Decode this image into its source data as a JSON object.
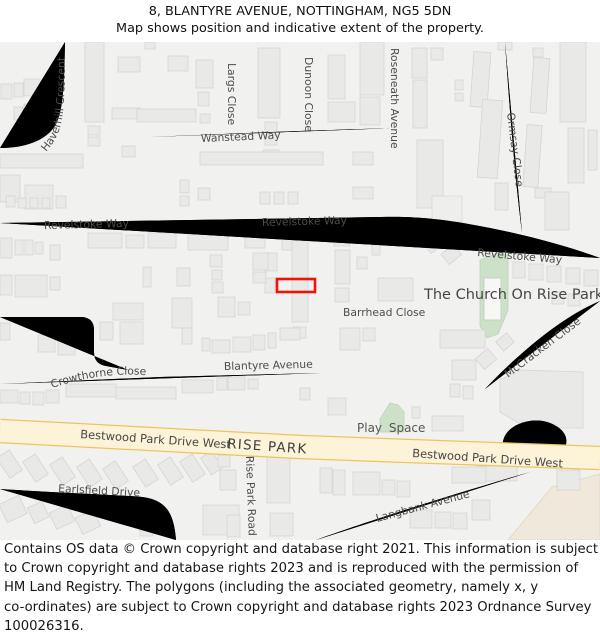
{
  "header": {
    "title": "8, BLANTYRE AVENUE, NOTTINGHAM, NG5 5DN",
    "subtitle": "Map shows position and indicative extent of the property."
  },
  "map": {
    "labels": {
      "haverhill": "Haverhill Crescent",
      "largs": "Largs Close",
      "dunoon": "Dunoon Close",
      "roseneath": "Roseneath Avenue",
      "ormsay": "Ormsay Close",
      "wanstead": "Wanstead Way",
      "revelstoke": "Revelstoke Way",
      "barrhead": "Barrhead Close",
      "church": "The Church On Rise Park",
      "mccracken": "McCracken Close",
      "blantyre": "Blantyre Avenue",
      "crowthorne": "Crowthorne Close",
      "bestwood": "Bestwood Park Drive West",
      "risepark": "RISE PARK",
      "earlsfield": "Earlsfield Drive",
      "riseparkroad": "Rise Park Road",
      "langbank": "Langbank Avenue",
      "playspace": "Play Space"
    },
    "colors": {
      "map_background": "#f1f1ef",
      "building_fill": "#e9e9e8",
      "road_fill": "#ffffff",
      "road_casing": "#d8d8d6",
      "primary_road_fill": "#fdf3d9",
      "primary_road_casing": "#eec45c",
      "green_area": "#cde1c9",
      "beige_area": "#efe8db",
      "property_highlight": "#ed1309"
    }
  },
  "footer": {
    "lines": [
      "Contains OS data © Crown copyright and database right 2021. This information is subject",
      "to Crown copyright and database rights 2023 and is reproduced with the permission of",
      "HM Land Registry. The polygons (including the associated geometry, namely x, y",
      "co-ordinates) are subject to Crown copyright and database rights 2023 Ordnance Survey",
      "100026316."
    ]
  }
}
